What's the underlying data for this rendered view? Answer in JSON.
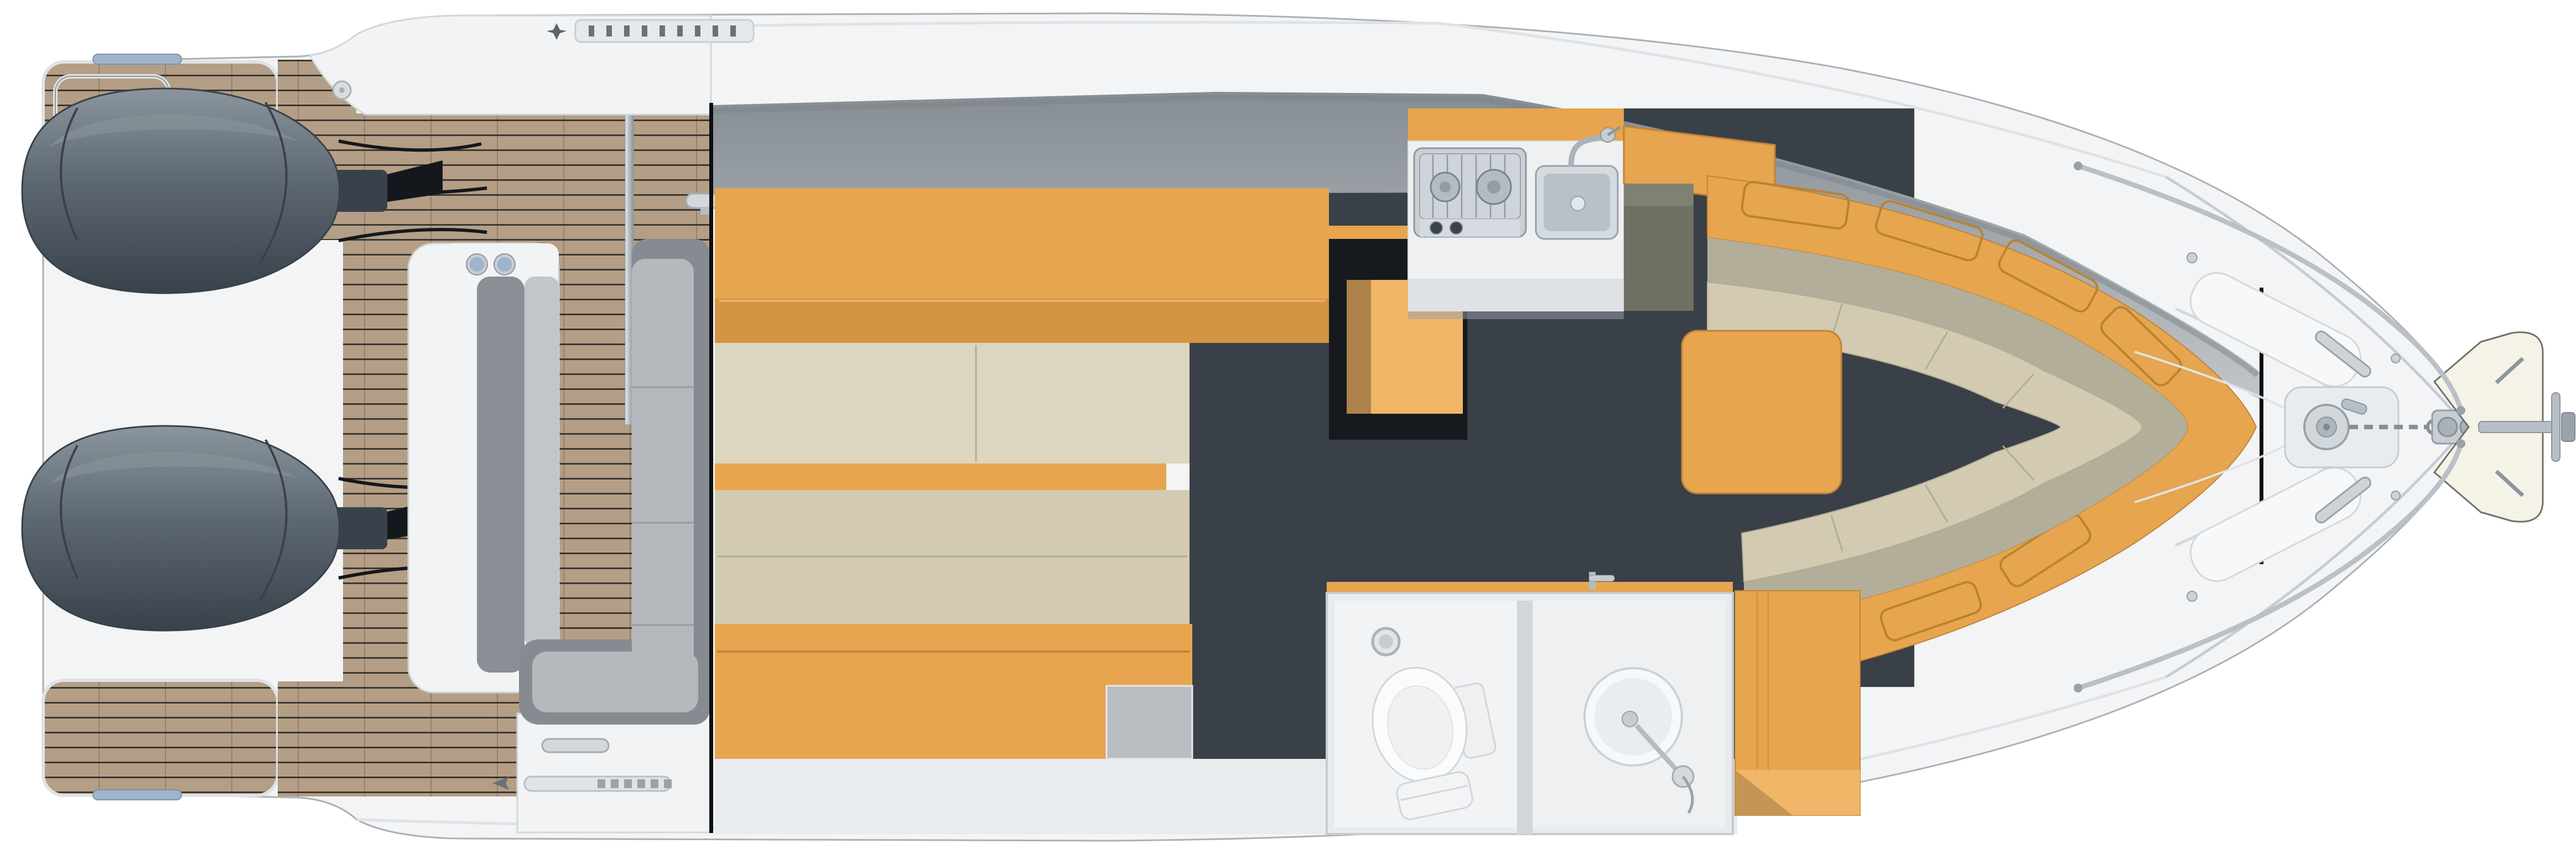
{
  "meta": {
    "title": "Motor yacht floor plan — top view with interior cutaway",
    "view": "overhead deck plan and lower-deck cutaway"
  },
  "colors": {
    "teak": "#b49e85",
    "teakLine": "#2f2e2a",
    "hullWhite": "#f3f4f5",
    "hullShade": "#dfe2e5",
    "hullLine": "#aab0b6",
    "gunwale": "#f1f3f4",
    "engine": "#5e6872",
    "engineDark": "#39424a",
    "engineLight": "#8b959d",
    "cable": "#14181c",
    "orange": "#e6a54e",
    "orangeDark": "#c08438",
    "orangeLight": "#f0b668",
    "beige": "#d2cbb2",
    "beigeDark": "#b3ac95",
    "beigeLight": "#dcd5bf",
    "backrest": "#b3ae9a",
    "floorDark": "#3a4048",
    "grayBandA": "#868d93",
    "grayBandB": "#c0c5c9",
    "seatGray": "#868b91",
    "seatCushion": "#b5b9bd",
    "seatSeam": "#989da3",
    "chrome": "#c7ccd2",
    "chromeDark": "#8e959c",
    "accentBlue": "#9fb3cb",
    "sage": "#6f7165",
    "counter": "#eef0f1",
    "bathWall": "#e8ebed",
    "bathRoom": "#f1f3f5",
    "porcelain": "#fafbfc",
    "floorStrip": "#e9ecee",
    "cutLine": "#0c0e10",
    "stepGray": "#b9bdc1",
    "anchorPale": "#f5f2e8"
  },
  "zones": {
    "swim_platform": {
      "label": "Teak swim platform with deck hatch, recessed handle and grab rails"
    },
    "engines": {
      "label": "Twin outboard engines on transom brackets",
      "count": 2
    },
    "transom_module": {
      "label": "Transom module with twin round fittings and shower pole"
    },
    "cockpit": {
      "label": "Teak cockpit with L-shaped lounge seating and side decks"
    },
    "gunwale_top": {
      "label": "Starboard side deck with vent strip, filler cap and mooring cleat"
    },
    "gunwale_bottom": {
      "label": "Port side deck with boarding ladder strip and mooring cleat"
    },
    "aft_cabin": {
      "label": "Mid cabin with double berth, shelf, drawers and hanging locker"
    },
    "galley": {
      "label": "Galley with two-burner stove, sink and stowage"
    },
    "salon": {
      "label": "Salon with curved dinette, storage hatches and wood table"
    },
    "head": {
      "label": "Head compartment with toilet, washbasin, shower wand and wardrobe"
    },
    "bow_deck": {
      "label": "Foredeck with sunpads, pulpit rails, windlass, chain and anchor"
    },
    "section_cuts": {
      "label": "Cutaway section lines revealing the lower deck"
    }
  }
}
